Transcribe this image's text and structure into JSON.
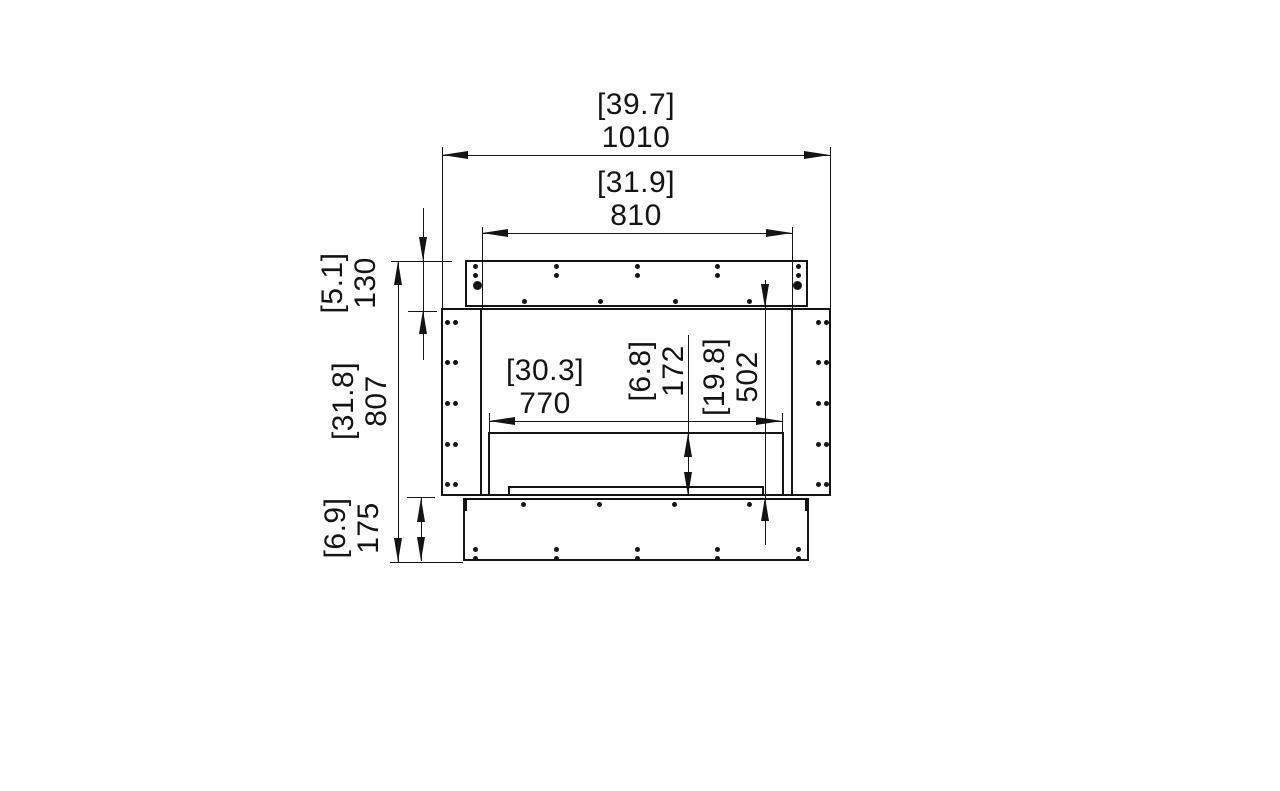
{
  "drawing": {
    "name": "firebox-front-elevation",
    "colors": {
      "line": "#141414",
      "background": "#ffffff"
    }
  },
  "dimensions": {
    "overall_width": {
      "inches": "[39.7]",
      "mm": "1010"
    },
    "flange_width": {
      "inches": "[31.9]",
      "mm": "810"
    },
    "opening_width": {
      "inches": "[30.3]",
      "mm": "770"
    },
    "top_flange_height": {
      "inches": "[5.1]",
      "mm": "130"
    },
    "overall_height": {
      "inches": "[31.8]",
      "mm": "807"
    },
    "bottom_flange_height": {
      "inches": "[6.9]",
      "mm": "175"
    },
    "opening_height": {
      "inches": "[6.8]",
      "mm": "172"
    },
    "body_height": {
      "inches": "[19.8]",
      "mm": "502"
    }
  }
}
